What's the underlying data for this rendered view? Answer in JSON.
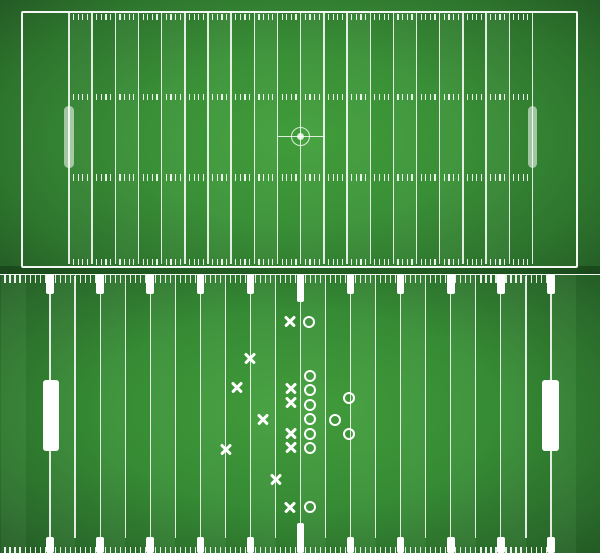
{
  "colors": {
    "line": "rgba(255,255,255,0.86)",
    "tick": "rgba(255,255,255,0.9)",
    "white": "#ffffff",
    "pale_bar": "rgba(255,255,255,0.55)",
    "circle": "rgba(255,255,255,0.82)",
    "field_bright": "#43a03c",
    "field_dark": "#235a24"
  },
  "top_field": {
    "yard_line_count": 21,
    "first_line_x": 69,
    "line_spacing": 23.17,
    "line_top": 13,
    "line_height": 251,
    "line_width": 1.4,
    "tick_rows_y": [
      13.5,
      93.5,
      174,
      258.5
    ],
    "tick_height": 6.5,
    "ticks_per_gap": 4,
    "goal_bars": {
      "centers_x": [
        69,
        532.4
      ],
      "y": 106,
      "w": 9.5,
      "h": 62
    },
    "center_circle": {
      "cx": 300.5,
      "cy": 136.8,
      "ring_d": 19,
      "ring_stroke": 1.9,
      "dot_d": 7.4
    },
    "midline": {
      "x": 277.5,
      "y": 136,
      "w": 47,
      "h": 1.4
    }
  },
  "bottom_field": {
    "yard_line_count": 21,
    "first_line_x": 50,
    "line_spacing": 25.05,
    "line_top": 275.5,
    "line_bottom": 538,
    "line_width": 1.2,
    "tick_pitch": 5.01,
    "tick_max_x": 553,
    "top_ticks": {
      "y": 275,
      "h": 7.8
    },
    "bottom_ticks": {
      "y": 547,
      "h": 6
    },
    "tabs": {
      "xs": [
        50,
        100.1,
        150.2,
        200.3,
        250.4,
        300.5,
        350.6,
        400.7,
        450.8,
        500.9,
        551
      ],
      "w": 7.6,
      "top_y": 274,
      "top_h": 19.5,
      "top_center_h": 27.5,
      "bottom_y": 537,
      "bottom_h": 16,
      "bottom_center_y": 523,
      "bottom_center_h": 30,
      "center_index": 5
    },
    "goal_bars": {
      "centers_x": [
        51,
        550.5
      ],
      "y": 380,
      "w": 16.5,
      "h": 71
    },
    "play": {
      "x_size": 11,
      "o_diameter": 12,
      "o_stroke": 2.6,
      "x_marks": [
        [
          290,
          321.5
        ],
        [
          250,
          358.5
        ],
        [
          236.5,
          387.5
        ],
        [
          291,
          388
        ],
        [
          291,
          402.5
        ],
        [
          263,
          419
        ],
        [
          291,
          433.5
        ],
        [
          291,
          447.5
        ],
        [
          225.5,
          449
        ],
        [
          276,
          479.5
        ],
        [
          290,
          507
        ]
      ],
      "o_marks": [
        [
          309,
          321.5
        ],
        [
          310,
          376
        ],
        [
          310,
          390
        ],
        [
          310,
          405
        ],
        [
          309.5,
          419
        ],
        [
          309.5,
          433.5
        ],
        [
          309.5,
          448
        ],
        [
          349,
          398
        ],
        [
          335,
          419.5
        ],
        [
          349,
          433.5
        ],
        [
          309.5,
          507
        ]
      ]
    }
  }
}
